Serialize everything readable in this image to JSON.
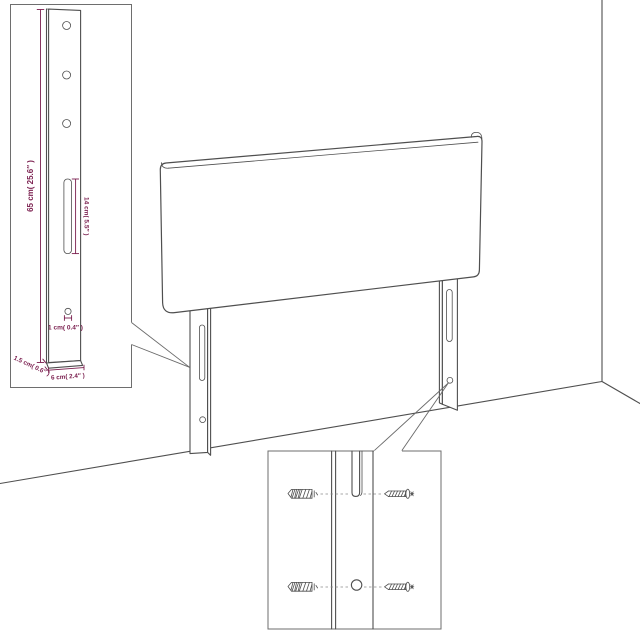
{
  "colors": {
    "background": "#ffffff",
    "line_art": "#4f4f4f",
    "dimension_accent": "#7a1e4e",
    "callout_border": "#6e6e6e"
  },
  "leg_detail_callout": {
    "height_label": "65 cm( 25.6″ )",
    "slot_height_label": "14 cm( 5.5″ )",
    "hole_diameter_label": "1 cm( 0.4″ )",
    "foot_thickness_label": "1.5 cm( 0.6″ )",
    "foot_width_label": "6 cm( 2.4″ )"
  },
  "hardware_detail_callout": {
    "top_row": [
      "wall-plug-icon",
      "slot",
      "screw-icon"
    ],
    "bottom_row": [
      "wall-plug-icon",
      "hole",
      "screw-icon"
    ]
  }
}
